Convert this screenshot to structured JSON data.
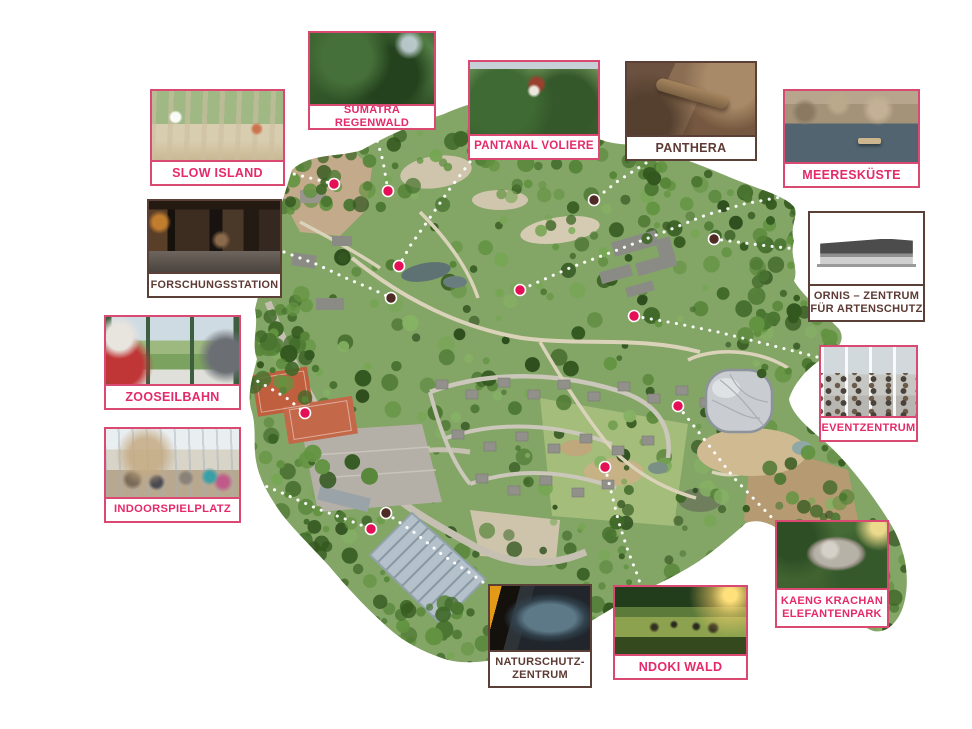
{
  "theme": {
    "background": "#ffffff",
    "pink_border": "#d94972",
    "pink_text": "#e42a6a",
    "pink_dot": "#e50f55",
    "dark_border": "#5a4037",
    "dark_text": "#5d3b34",
    "dark_dot": "#4f2b25",
    "connector_color": "#ffffff"
  },
  "map": {
    "description_name": "zoo-aerial-map"
  },
  "callouts": [
    {
      "id": "slow-island",
      "label": "SLOW ISLAND",
      "color": "pink",
      "dot": {
        "x": 334,
        "y": 184
      },
      "line": [
        [
          286,
          172
        ],
        [
          310,
          178
        ],
        [
          334,
          184
        ]
      ]
    },
    {
      "id": "sumatra-regenwald",
      "label": "SUMATRA REGENWALD",
      "color": "pink",
      "dot": {
        "x": 388,
        "y": 191
      },
      "line": [
        [
          375,
          133
        ],
        [
          383,
          161
        ],
        [
          388,
          191
        ]
      ]
    },
    {
      "id": "pantanal-voliere",
      "label": "PANTANAL VOLIERE",
      "color": "pink",
      "dot": {
        "x": 399,
        "y": 266
      },
      "line": [
        [
          470,
          162
        ],
        [
          449,
          190
        ],
        [
          427,
          222
        ],
        [
          410,
          246
        ],
        [
          399,
          266
        ]
      ]
    },
    {
      "id": "panthera",
      "label": "PANTHERA",
      "color": "dark",
      "dot": {
        "x": 594,
        "y": 200
      },
      "line": [
        [
          646,
          163
        ],
        [
          618,
          181
        ],
        [
          594,
          200
        ]
      ]
    },
    {
      "id": "meereskueste",
      "label": "MEERESKÜSTE",
      "color": "pink",
      "dot": {
        "x": 520,
        "y": 290
      },
      "line": [
        [
          786,
          196
        ],
        [
          744,
          204
        ],
        [
          706,
          215
        ],
        [
          664,
          232
        ],
        [
          620,
          249
        ],
        [
          572,
          267
        ],
        [
          520,
          290
        ]
      ]
    },
    {
      "id": "ornis",
      "label": "ORNIS – ZENTRUM\nFÜR ARTENSCHUTZ",
      "color": "dark",
      "dot": {
        "x": 714,
        "y": 239
      },
      "line": [
        [
          806,
          250
        ],
        [
          768,
          246
        ],
        [
          714,
          239
        ]
      ]
    },
    {
      "id": "forschungsstation",
      "label": "FORSCHUNGSSTATION",
      "color": "dark",
      "dot": {
        "x": 391,
        "y": 298
      },
      "line": [
        [
          284,
          252
        ],
        [
          316,
          264
        ],
        [
          348,
          279
        ],
        [
          372,
          289
        ],
        [
          391,
          298
        ]
      ]
    },
    {
      "id": "zooseilbahn",
      "label": "ZOOSEILBAHN",
      "color": "pink",
      "dot": {
        "x": 305,
        "y": 413
      },
      "line": [
        [
          243,
          373
        ],
        [
          268,
          387
        ],
        [
          288,
          399
        ],
        [
          305,
          413
        ]
      ]
    },
    {
      "id": "eventzentrum",
      "label": "EVENTZENTRUM",
      "color": "pink",
      "dot": {
        "x": 634,
        "y": 316
      },
      "line": [
        [
          817,
          357
        ],
        [
          770,
          345
        ],
        [
          718,
          332
        ],
        [
          674,
          323
        ],
        [
          634,
          316
        ]
      ]
    },
    {
      "id": "indoorspielplatz",
      "label": "INDOORSPIELPLATZ",
      "color": "pink",
      "dot": {
        "x": 371,
        "y": 529
      },
      "line": [
        [
          243,
          477
        ],
        [
          280,
          492
        ],
        [
          318,
          509
        ],
        [
          348,
          520
        ],
        [
          371,
          529
        ]
      ]
    },
    {
      "id": "naturschutz-zentrum",
      "label": "NATURSCHUTZ-\nZENTRUM",
      "color": "dark",
      "dot": {
        "x": 386,
        "y": 513
      },
      "line": [
        [
          386,
          513
        ],
        [
          415,
          533
        ],
        [
          444,
          556
        ],
        [
          470,
          573
        ],
        [
          487,
          585
        ]
      ]
    },
    {
      "id": "ndoki-wald",
      "label": "NDOKI WALD",
      "color": "pink",
      "dot": {
        "x": 605,
        "y": 467
      },
      "line": [
        [
          605,
          467
        ],
        [
          612,
          495
        ],
        [
          619,
          523
        ],
        [
          628,
          551
        ],
        [
          637,
          574
        ],
        [
          641,
          586
        ]
      ]
    },
    {
      "id": "kaeng-krachan",
      "label": "KAENG KRACHAN\nELEFANTENPARK",
      "color": "pink",
      "dot": {
        "x": 678,
        "y": 406
      },
      "line": [
        [
          678,
          406
        ],
        [
          697,
          430
        ],
        [
          714,
          452
        ],
        [
          734,
          478
        ],
        [
          755,
          500
        ],
        [
          774,
          520
        ]
      ]
    }
  ]
}
